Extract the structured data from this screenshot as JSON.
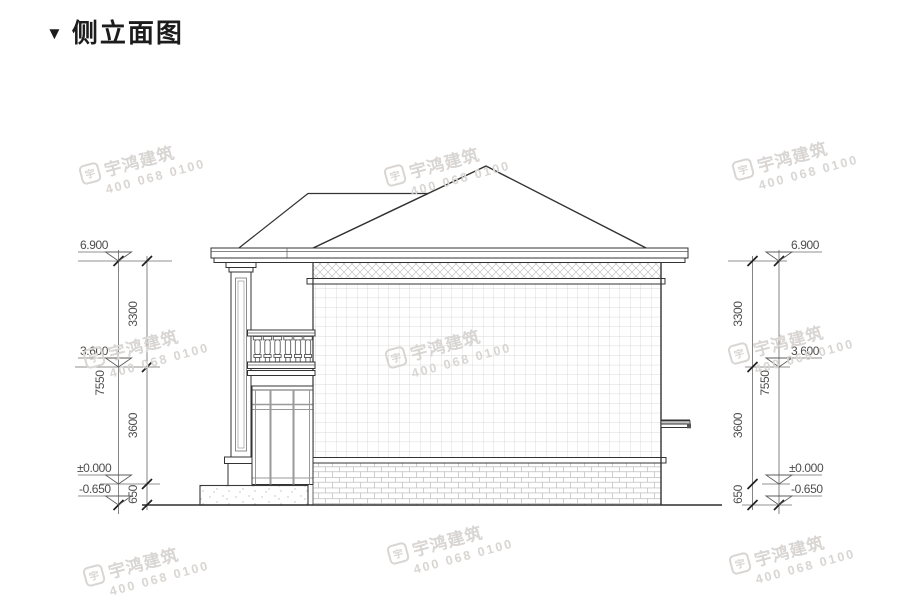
{
  "title": {
    "marker": "▼",
    "text": "侧立面图"
  },
  "watermark": {
    "logo_char": "宇",
    "brand": "宇鸿建筑",
    "phone": "400 068 0100",
    "color": "#d8d5d2"
  },
  "dims": {
    "left": {
      "levels": [
        "6.900",
        "3.600",
        "±0.000",
        "-0.650"
      ],
      "segments": [
        "3300",
        "3600",
        "650"
      ],
      "overall": "7550"
    },
    "right": {
      "levels": [
        "6.900",
        "3.600",
        "±0.000",
        "-0.650"
      ],
      "segments": [
        "3300",
        "3600",
        "650"
      ],
      "overall": "7550"
    }
  },
  "colors": {
    "line": "#333333",
    "dim_text": "#4d4d4d",
    "pattern": "#c9c9c9",
    "watermark": "#d8d5d2",
    "background": "#ffffff"
  }
}
